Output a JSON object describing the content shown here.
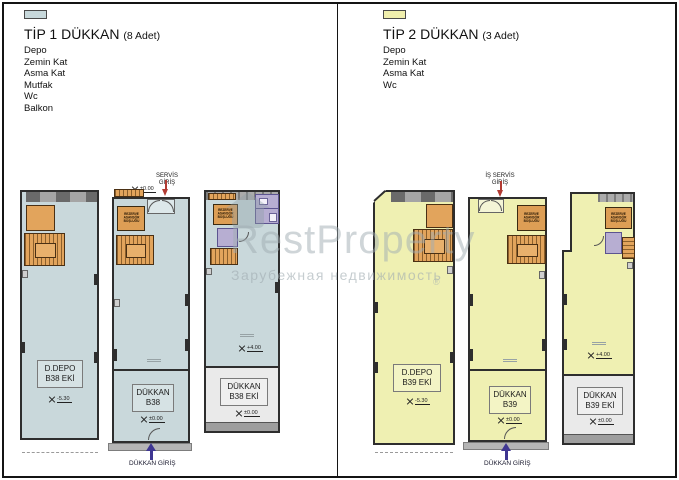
{
  "legend_tip1": {
    "title": "TİP 1 DÜKKAN",
    "count": "(8 Adet)",
    "swatch_color": "#c7d8db",
    "items": [
      "Depo",
      "Zemin Kat",
      "Asma Kat",
      "Mutfak",
      "Wc",
      "Balkon"
    ]
  },
  "legend_tip2": {
    "title": "TİP 2 DÜKKAN",
    "count": "(3 Adet)",
    "swatch_color": "#f0efad",
    "items": [
      "Depo",
      "Zemin Kat",
      "Asma Kat",
      "Wc"
    ]
  },
  "watermark": {
    "brand": "RestProperty",
    "subtitle": "Зарубежная недвижимость",
    "registered": "®"
  },
  "annotations": {
    "service_entry_line1": "SERVİS",
    "service_entry_line2": "GİRİŞ",
    "service_entry_right_line1": "İŞ SERVİS",
    "service_entry_right_line2": "GİRİŞ",
    "shop_entry": "DÜKKAN GİRİŞ",
    "reserve_elevator": "REZERVE ASANSÖR BOŞLUĞU"
  },
  "plans": {
    "depo_b38": {
      "name_line1": "D.DEPO",
      "name_line2": "B38 EKİ",
      "level": "-5.30"
    },
    "dukkan_b38": {
      "name_line1": "DÜKKAN",
      "name_line2": "B38",
      "level_service": "±0.00",
      "level_entry": "±0.00"
    },
    "dukkan_b38_eki": {
      "name_line1": "DÜKKAN",
      "name_line2": "B38 EKİ",
      "level_upper": "+4.00",
      "level_entry": "±0.00"
    },
    "depo_b39": {
      "name_line1": "D.DEPO",
      "name_line2": "B39 EKİ",
      "level": "-5.30"
    },
    "dukkan_b39": {
      "name_line1": "DÜKKAN",
      "name_line2": "B39",
      "level_entry": "±0.00"
    },
    "dukkan_b39_eki": {
      "name_line1": "DÜKKAN",
      "name_line2": "B39 EKİ",
      "level_upper": "+4.00",
      "level_entry": "±0.00"
    }
  },
  "colors": {
    "tip1_fill": "#c9d8db",
    "tip2_fill": "#eff0b2",
    "stairs_orange": "#e2a45c",
    "wall_dark": "#2e2e2e",
    "annex_grey": "#eaeaea",
    "purple_room": "#b7aed2",
    "entry_arrow_purple": "#3f3692",
    "service_arrow_red": "#b23b33",
    "watermark_grey": "#8fa0a6"
  }
}
